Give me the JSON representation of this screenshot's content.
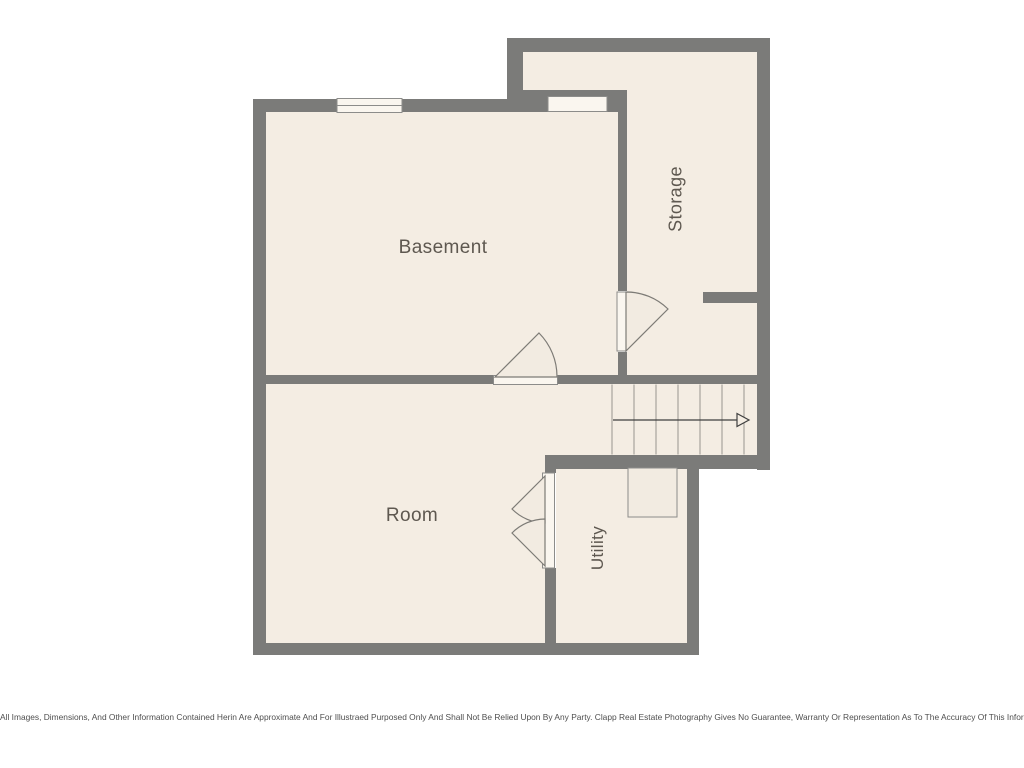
{
  "floorplan": {
    "rooms": {
      "basement": {
        "label": "Basement"
      },
      "storage": {
        "label": "Storage"
      },
      "room": {
        "label": "Room"
      },
      "utility": {
        "label": "Utility"
      }
    },
    "stairs": {
      "arrow_direction": "right"
    },
    "colors": {
      "wall": "#7b7b79",
      "floor": "#f4ede3",
      "window_fill": "#faf6ef",
      "outline": "#8c8c8a",
      "label_text": "#5e5850",
      "arrow": "#3f3f3f",
      "page_background": "#ffffff"
    }
  },
  "footer": {
    "disclaimer": "All Images, Dimensions, And Other Information Contained Herin Are Approximate And For Illustraed Purposed Only And Shall Not Be Relied Upon By Any Party. Clapp Real Estate Photography Gives No Guarantee, Warranty Or Representation As To The Accuracy Of This Information."
  }
}
